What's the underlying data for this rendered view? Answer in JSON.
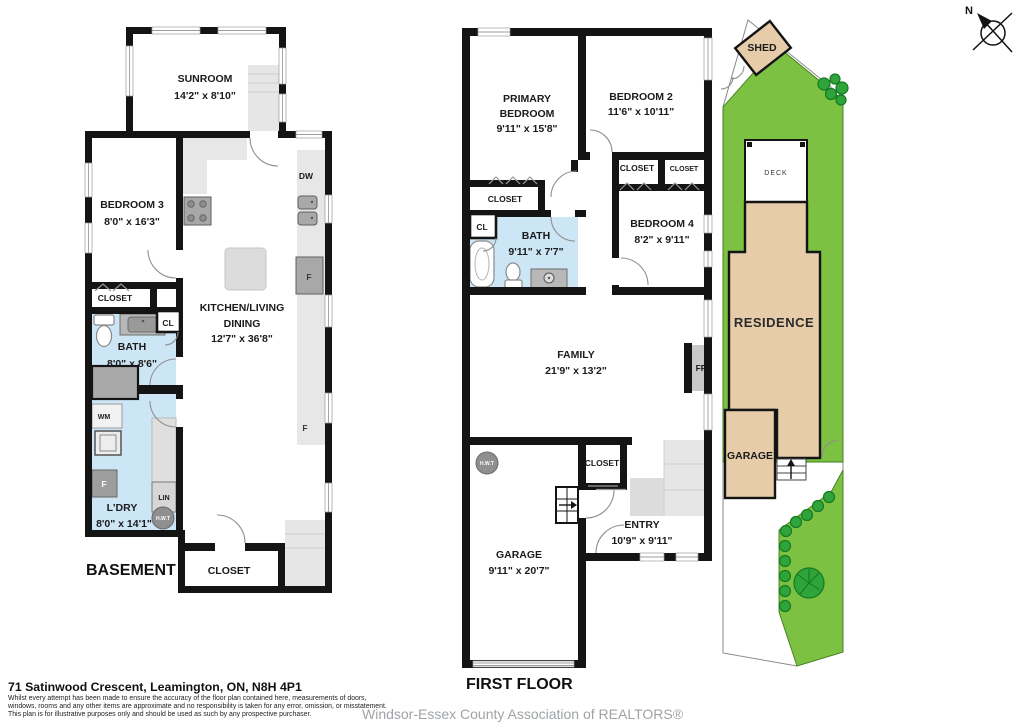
{
  "address": "71 Satinwood Crescent, Leamington, ON, N8H 4P1",
  "disclaimer": {
    "line1": "Whilst every attempt has been made to ensure the accuracy of the floor plan contained here, measurements of doors,",
    "line2": "windows, rooms and any other items are approximate and no responsibility is taken for any error, omission, or misstatement.",
    "line3": "This plan is for illustrative purposes only and should be used as such by any prospective purchaser."
  },
  "watermark": "Windsor-Essex County Association of REALTORS®",
  "compass": {
    "north": "N"
  },
  "basement": {
    "title": "BASEMENT",
    "sunroom": {
      "name": "SUNROOM",
      "dims": "14'2\" x 8'10\""
    },
    "bedroom3": {
      "name": "BEDROOM 3",
      "dims": "8'0\" x 16'3\""
    },
    "closet": "CLOSET",
    "bath": {
      "name": "BATH",
      "dims": "8'0\" x 8'6\""
    },
    "cl": "CL",
    "wm": "WM",
    "freezer": "F",
    "laundry": {
      "name": "L'DRY",
      "dims": "8'0\" x 14'1\""
    },
    "lin": "LIN",
    "hwt": "H.W.T",
    "kitchen": {
      "line1": "KITCHEN/LIVING",
      "line2": "DINING",
      "dims": "12'7\" x 36'8\""
    },
    "dw": "DW",
    "fridge": "F",
    "freezer2": "F",
    "closet_rear": "CLOSET"
  },
  "first_floor": {
    "title": "FIRST FLOOR",
    "primary": {
      "line1": "PRIMARY",
      "line2": "BEDROOM",
      "dims": "9'11\" x 15'8\""
    },
    "bedroom2": {
      "name": "BEDROOM 2",
      "dims": "11'6\" x 10'11\""
    },
    "closet_primary": "CLOSET",
    "cl": "CL",
    "bath": {
      "name": "BATH",
      "dims": "9'11\" x 7'7\""
    },
    "closet_a": "CLOSET",
    "closet_b": "CLOSET",
    "bedroom4": {
      "name": "BEDROOM 4",
      "dims": "8'2\" x 9'11\""
    },
    "family": {
      "name": "FAMILY",
      "dims": "21'9\" x 13'2\""
    },
    "fp": "FP",
    "hwt": "H.W.T",
    "closet_entry": "CLOSET",
    "entry": {
      "name": "ENTRY",
      "dims": "10'9\" x 9'11\""
    },
    "garage": {
      "name": "GARAGE",
      "dims": "9'11\" x 20'7\""
    }
  },
  "site": {
    "shed": "SHED",
    "deck": "DECK",
    "residence": "RESIDENCE",
    "garage": "GARAGE"
  },
  "colors": {
    "wall": "#141414",
    "bath_floor": "#cde6f5",
    "grass": "#7cc142",
    "shrub": "#2fa43b",
    "building_tan": "#e7cca9",
    "counter_gray": "#e7e7e7",
    "watermark_gray": "#9fa3a6"
  }
}
